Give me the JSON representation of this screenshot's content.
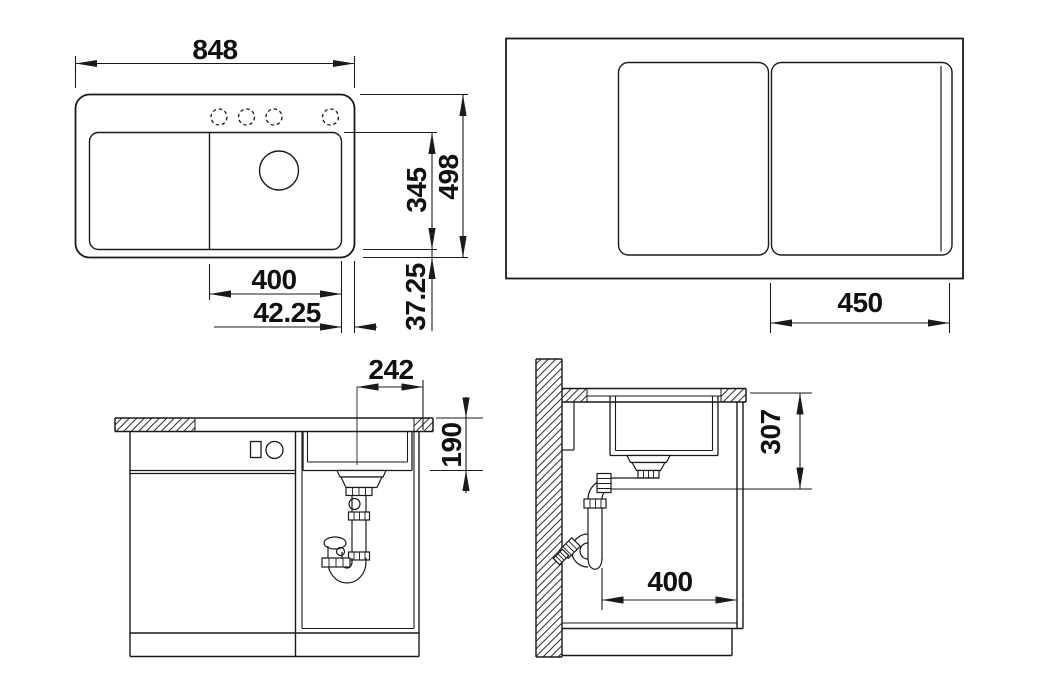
{
  "drawing": {
    "kind": "kitchen sink installation drawing",
    "ink_color": "#1a1a1a",
    "background_color": "#ffffff",
    "views": {
      "plan": {
        "label": "sink plan view",
        "dims": {
          "overall_width": "848",
          "bowl_depth": "345",
          "overall_depth": "498",
          "bowl_width": "400",
          "bowl_edge_offset": "42.25",
          "bowl_edge_offset_depth": "37.25"
        }
      },
      "cover_plan": {
        "label": "plan view with sliding covers",
        "dims": {
          "cover_width": "450"
        }
      },
      "front_section": {
        "label": "front section through base cabinet",
        "dims": {
          "drain_center_offset": "242",
          "bowl_height": "190"
        }
      },
      "side_section": {
        "label": "side section at wall",
        "dims": {
          "outlet_height": "307",
          "clearance_depth": "400"
        }
      }
    }
  }
}
